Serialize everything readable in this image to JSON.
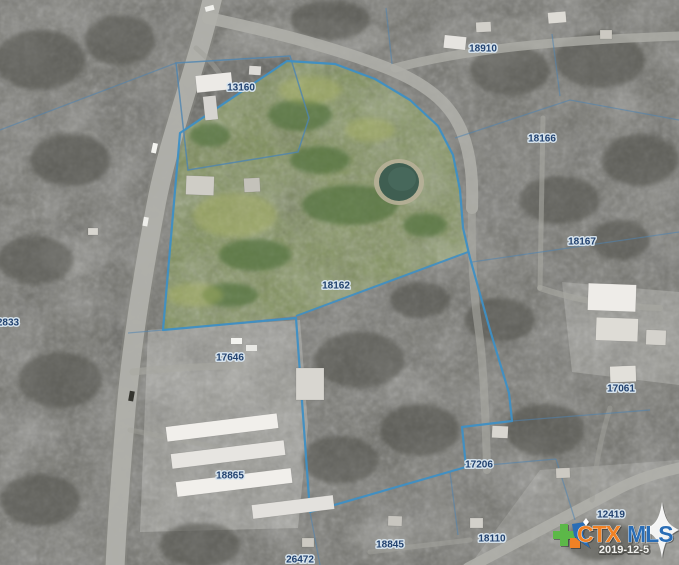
{
  "map": {
    "type": "aerial-parcel-map",
    "parcel_labels": [
      {
        "id": "13160",
        "x": 241,
        "y": 87
      },
      {
        "id": "18910",
        "x": 483,
        "y": 48
      },
      {
        "id": "18166",
        "x": 542,
        "y": 138
      },
      {
        "id": "18167",
        "x": 582,
        "y": 241
      },
      {
        "id": "18162",
        "x": 336,
        "y": 285
      },
      {
        "id": "2833",
        "x": 8,
        "y": 322
      },
      {
        "id": "17646",
        "x": 230,
        "y": 357
      },
      {
        "id": "17061",
        "x": 621,
        "y": 388
      },
      {
        "id": "18865",
        "x": 230,
        "y": 475
      },
      {
        "id": "17206",
        "x": 479,
        "y": 464
      },
      {
        "id": "12419",
        "x": 611,
        "y": 514
      },
      {
        "id": "18110",
        "x": 492,
        "y": 538
      },
      {
        "id": "18845",
        "x": 390,
        "y": 544
      },
      {
        "id": "26472",
        "x": 300,
        "y": 559
      }
    ],
    "main_parcel_outline": "287,61 335,64 375,79 410,100 438,126 453,155 460,190 463,228 470,258 490,330 509,393 512,421 462,427 466,467 310,512 296,318 163,330 180,133",
    "highlight_polygon": "180,133 287,61 335,64 375,79 410,100 438,126 453,155 460,190 463,228 468,252 296,316 163,330",
    "inner_boundary": "468,252 296,316",
    "colors": {
      "boundary": "#3e8fc4",
      "label_text": "#1c3e6e",
      "label_halo": "#d9e6f0",
      "highlight_green": "#7d9150",
      "pond": "#3f5e51"
    }
  },
  "watermark": {
    "brand_prefix": "CTX",
    "brand_suffix": "MLS",
    "date": "2019-12-5",
    "colors": {
      "prefix": "#f08124",
      "suffix": "#2a6db5",
      "star": "#ffffff",
      "texas_green": "#5cb848",
      "texas_orange": "#f08124",
      "texas_blue": "#2a6db5"
    }
  }
}
